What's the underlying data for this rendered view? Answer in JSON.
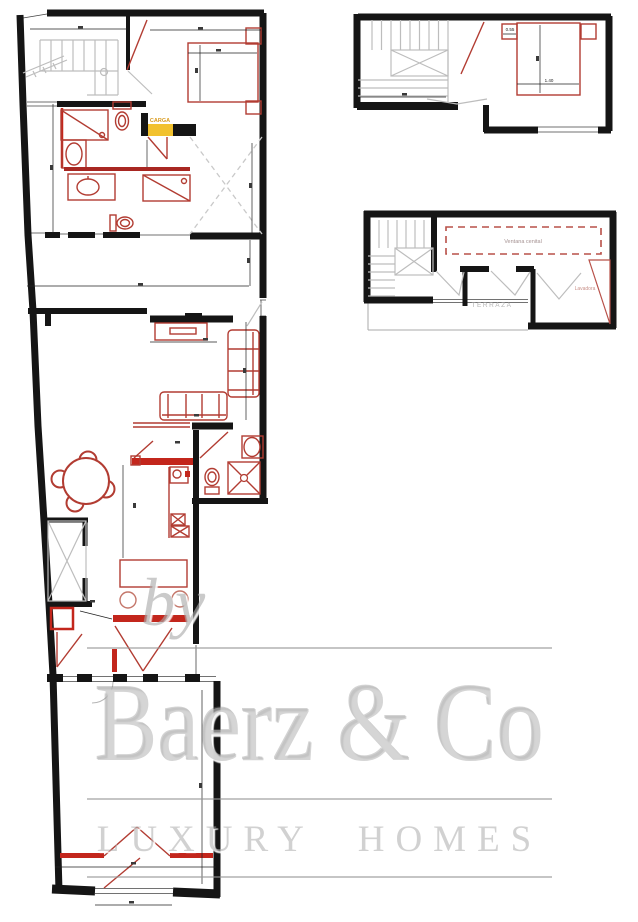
{
  "watermark": {
    "prefix": "by",
    "brand": "Baerz & Co",
    "tagline": "LUXURY HOMES"
  },
  "plan_labels": {
    "carga": "CARGA",
    "terraza": "TERRAZA",
    "skylight": "Ventana cenital",
    "washer": "Lavadora"
  },
  "dimension_labels": {
    "nightstand_width": "0.55",
    "bed_width": "1.40"
  },
  "colors": {
    "background": "#ffffff",
    "wall_black": "#151515",
    "fixture_red": "#b23c32",
    "accent_red": "#c3261c",
    "dark_red_wall": "#a82722",
    "carga_yellow": "#f2c12e",
    "carga_text_orange": "#d99a1c",
    "stair_gray": "#bdbdbd",
    "dashed_gray": "#c9c9c9",
    "watermark_gray": "#c0c0c0",
    "skylight_dashed_red": "#b85048",
    "terraza_text_gray": "#b3b3b3",
    "lavadora_text_pink": "#c9918a"
  }
}
